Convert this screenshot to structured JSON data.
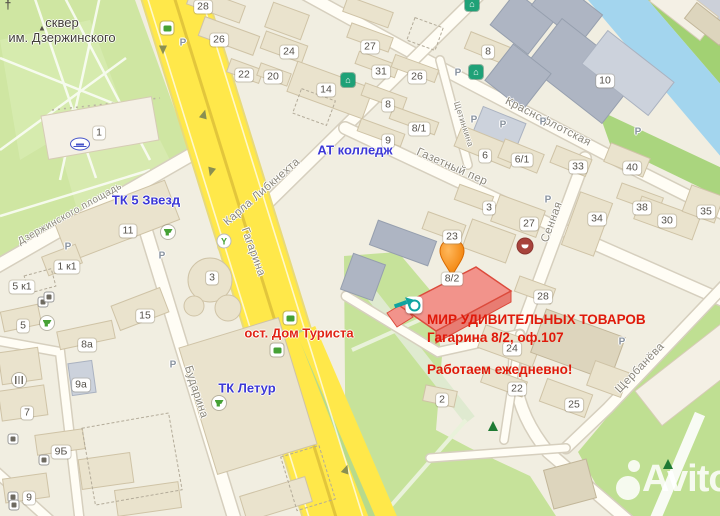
{
  "map": {
    "watermark": {
      "brand": "Avito"
    },
    "highlight": {
      "building_label": "8/2"
    },
    "annotation": {
      "line1": "МИР УДИВИТЕЛЬНЫХ ТОВАРОВ",
      "line2": "Гагарина 8/2, оф.107",
      "line3": "Работаем ежедневно!"
    },
    "colors": {
      "road_yellow": "#ffe84a",
      "park_green": "#cfe6a2",
      "water_blue": "#a3d5ee",
      "highlight_fill": "#f2938b",
      "highlight_stroke": "#dc4b3c",
      "pin_orange": "#f07c00",
      "poi_blue": "#3c38d6",
      "poi_red": "#e02415"
    },
    "poi_labels": [
      {
        "t": "сквер\nим. Дзержинского",
        "x": 62,
        "y": 30,
        "color": "#44413a",
        "w": 400,
        "size": 13
      },
      {
        "t": "ТК 5 Звезд",
        "x": 146,
        "y": 200,
        "color": "#3c38d6"
      },
      {
        "t": "АТ колледж",
        "x": 355,
        "y": 150,
        "color": "#3c38d6"
      },
      {
        "t": "ТК Летур",
        "x": 247,
        "y": 388,
        "color": "#3c38d6"
      },
      {
        "t": "ост. Дом Туриста",
        "x": 299,
        "y": 333,
        "color": "#e02415"
      }
    ],
    "street_labels": [
      {
        "t": "Карла Либкнехта",
        "x": 262,
        "y": 192,
        "rot": -41
      },
      {
        "t": "Гагарина",
        "x": 253,
        "y": 252,
        "rot": 70
      },
      {
        "t": "Краснофлотская",
        "x": 548,
        "y": 122,
        "rot": 27
      },
      {
        "t": "Газетный пер",
        "x": 452,
        "y": 167,
        "rot": 24
      },
      {
        "t": "Сенная",
        "x": 552,
        "y": 222,
        "rot": -70
      },
      {
        "t": "Щербанёва",
        "x": 640,
        "y": 368,
        "rot": -46
      },
      {
        "t": "Бударина",
        "x": 196,
        "y": 392,
        "rot": 72
      },
      {
        "t": "Дзержинского площадь",
        "x": 70,
        "y": 214,
        "rot": -29,
        "size": 10
      },
      {
        "t": "Щетинкина",
        "x": 464,
        "y": 124,
        "rot": 72,
        "size": 8.5
      }
    ],
    "building_labels": [
      {
        "t": "28",
        "x": 203,
        "y": 7
      },
      {
        "t": "26",
        "x": 219,
        "y": 40
      },
      {
        "t": "24",
        "x": 289,
        "y": 52
      },
      {
        "t": "22",
        "x": 244,
        "y": 75
      },
      {
        "t": "20",
        "x": 273,
        "y": 77
      },
      {
        "t": "14",
        "x": 326,
        "y": 90
      },
      {
        "t": "27",
        "x": 370,
        "y": 47
      },
      {
        "t": "31",
        "x": 381,
        "y": 72
      },
      {
        "t": "26",
        "x": 417,
        "y": 77
      },
      {
        "t": "8",
        "x": 388,
        "y": 105
      },
      {
        "t": "8/1",
        "x": 419,
        "y": 129
      },
      {
        "t": "9",
        "x": 388,
        "y": 141
      },
      {
        "t": "8",
        "x": 488,
        "y": 52
      },
      {
        "t": "10",
        "x": 605,
        "y": 81
      },
      {
        "t": "6",
        "x": 485,
        "y": 156
      },
      {
        "t": "6/1",
        "x": 522,
        "y": 160
      },
      {
        "t": "33",
        "x": 578,
        "y": 167
      },
      {
        "t": "40",
        "x": 632,
        "y": 168
      },
      {
        "t": "38",
        "x": 642,
        "y": 208
      },
      {
        "t": "30",
        "x": 667,
        "y": 221
      },
      {
        "t": "35",
        "x": 706,
        "y": 212
      },
      {
        "t": "34",
        "x": 597,
        "y": 219
      },
      {
        "t": "3",
        "x": 489,
        "y": 208
      },
      {
        "t": "27",
        "x": 529,
        "y": 224
      },
      {
        "t": "23",
        "x": 452,
        "y": 237
      },
      {
        "t": "28",
        "x": 543,
        "y": 297
      },
      {
        "t": "24",
        "x": 512,
        "y": 349
      },
      {
        "t": "22",
        "x": 517,
        "y": 389
      },
      {
        "t": "25",
        "x": 574,
        "y": 405
      },
      {
        "t": "2",
        "x": 442,
        "y": 400
      },
      {
        "t": "1",
        "x": 99,
        "y": 133
      },
      {
        "t": "11",
        "x": 128,
        "y": 231
      },
      {
        "t": "1 к1",
        "x": 67,
        "y": 267
      },
      {
        "t": "5 к1",
        "x": 22,
        "y": 287
      },
      {
        "t": "5",
        "x": 23,
        "y": 326
      },
      {
        "t": "3",
        "x": 212,
        "y": 278
      },
      {
        "t": "15",
        "x": 145,
        "y": 316
      },
      {
        "t": "8а",
        "x": 87,
        "y": 345
      },
      {
        "t": "9а",
        "x": 81,
        "y": 385
      },
      {
        "t": "7",
        "x": 27,
        "y": 413
      },
      {
        "t": "9Б",
        "x": 61,
        "y": 452
      },
      {
        "t": "9",
        "x": 29,
        "y": 498
      }
    ],
    "parking_markers": [
      {
        "t": "P",
        "x": 183,
        "y": 43
      },
      {
        "t": "P",
        "x": 458,
        "y": 73
      },
      {
        "t": "P",
        "x": 474,
        "y": 120
      },
      {
        "t": "P",
        "x": 503,
        "y": 125
      },
      {
        "t": "P",
        "x": 543,
        "y": 122
      },
      {
        "t": "P",
        "x": 548,
        "y": 200
      },
      {
        "t": "P",
        "x": 162,
        "y": 256
      },
      {
        "t": "P",
        "x": 68,
        "y": 247
      },
      {
        "t": "P",
        "x": 638,
        "y": 132
      },
      {
        "t": "P",
        "x": 622,
        "y": 342
      },
      {
        "t": "P",
        "x": 173,
        "y": 365
      }
    ],
    "icons": [
      {
        "name": "church-icon",
        "kind": "church",
        "x": 8,
        "y": 5
      },
      {
        "name": "monument-icon",
        "kind": "monument",
        "x": 42,
        "y": 28
      },
      {
        "name": "bench-icon",
        "kind": "bench",
        "x": 80,
        "y": 144
      },
      {
        "name": "roundabout-icon",
        "kind": "roundabout",
        "x": 224,
        "y": 241
      },
      {
        "name": "museum-icon",
        "kind": "museum",
        "x": 348,
        "y": 80
      },
      {
        "name": "museum-icon",
        "kind": "museum",
        "x": 476,
        "y": 72
      },
      {
        "name": "museum-icon",
        "kind": "museum",
        "x": 472,
        "y": 4
      },
      {
        "name": "bus-stop-icon",
        "kind": "bus",
        "x": 167,
        "y": 28
      },
      {
        "name": "bus-stop-icon",
        "kind": "bus",
        "x": 290,
        "y": 318
      },
      {
        "name": "bus-stop-icon",
        "kind": "bus",
        "x": 277,
        "y": 350
      },
      {
        "name": "shopping-cart-icon",
        "kind": "cart",
        "x": 168,
        "y": 232
      },
      {
        "name": "shopping-cart-icon",
        "kind": "cart",
        "x": 47,
        "y": 323
      },
      {
        "name": "shopping-cart-icon",
        "kind": "cart",
        "x": 219,
        "y": 403
      },
      {
        "name": "restaurant-icon",
        "kind": "restaurant",
        "x": 19,
        "y": 380
      },
      {
        "name": "theater-icon",
        "kind": "theater",
        "x": 525,
        "y": 246
      },
      {
        "name": "tree-icon",
        "kind": "tree",
        "x": 493,
        "y": 426
      },
      {
        "name": "tree-icon",
        "kind": "tree",
        "x": 668,
        "y": 464
      },
      {
        "name": "shop-marker-icon",
        "kind": "shopmark",
        "x": 414,
        "y": 305
      },
      {
        "name": "entrance-arrow-icon",
        "kind": "arrow",
        "x": 404,
        "y": 303,
        "rot": -20
      },
      {
        "name": "road-direction-arrow-icon",
        "kind": "roadarrow",
        "x": 163,
        "y": 50,
        "rot": 180
      },
      {
        "name": "road-direction-arrow-icon",
        "kind": "roadarrow",
        "x": 204,
        "y": 114,
        "rot": 15
      },
      {
        "name": "road-direction-arrow-icon",
        "kind": "roadarrow",
        "x": 211,
        "y": 172,
        "rot": 195
      },
      {
        "name": "road-direction-arrow-icon",
        "kind": "roadarrow",
        "x": 346,
        "y": 469,
        "rot": 18
      },
      {
        "name": "small-poi-icon",
        "kind": "small",
        "x": 43,
        "y": 302
      },
      {
        "name": "small-poi-icon",
        "kind": "small",
        "x": 49,
        "y": 297
      },
      {
        "name": "small-poi-icon",
        "kind": "small",
        "x": 13,
        "y": 439
      },
      {
        "name": "small-poi-icon",
        "kind": "small",
        "x": 13,
        "y": 497
      },
      {
        "name": "small-poi-icon",
        "kind": "small",
        "x": 14,
        "y": 505
      },
      {
        "name": "small-poi-icon",
        "kind": "small",
        "x": 44,
        "y": 460
      }
    ]
  }
}
